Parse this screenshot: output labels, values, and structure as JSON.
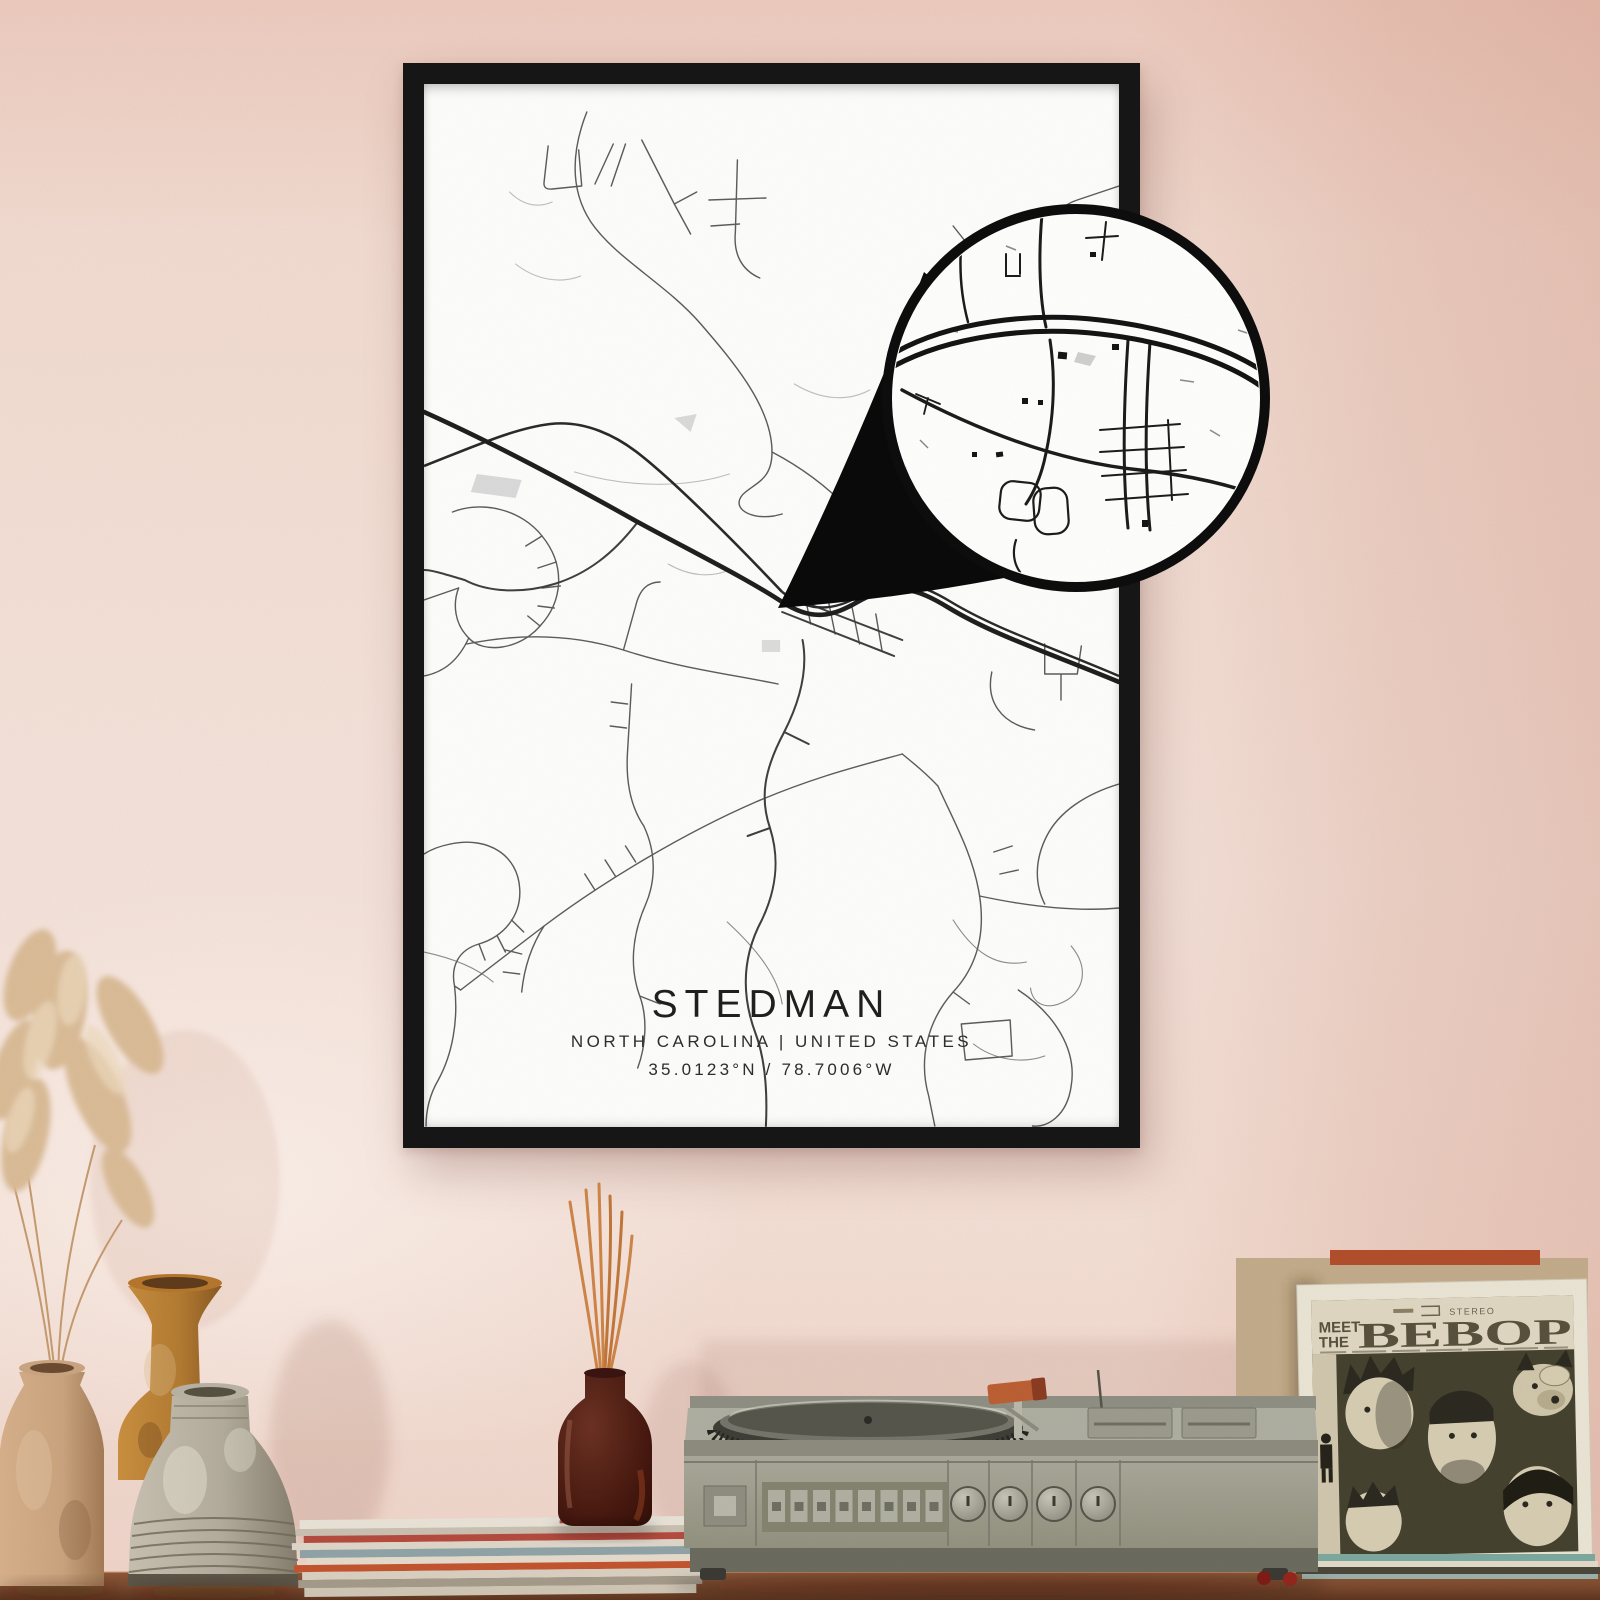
{
  "poster": {
    "title": "STEDMAN",
    "subtitle": "NORTH CAROLINA | UNITED STATES",
    "coordinates": "35.0123°N / 78.7006°W"
  },
  "record_sleeve": {
    "pretitle_line1": "MEET",
    "pretitle_line2": "THE",
    "title": "BEBOP",
    "stereo_label": "STEREO"
  },
  "colors": {
    "wall_pink": "#f1dcd2",
    "wall_shadow": "#dfae9c",
    "frame": "#161616",
    "paper": "#fcfcfa",
    "road_major": "#1f1f1f",
    "road_minor": "#5c5c5c",
    "wood_shelf": "#7c4a2f",
    "turntable_body": "#a3a294",
    "diffuser_glass": "#46180f",
    "reed_sticks": "#cd8448",
    "vase_tan": "#c9a37e",
    "vase_amber": "#b27a31",
    "vase_gray": "#b3ac9c",
    "sleeve_art": "#45412f",
    "sleeve_paper": "#e9e3d3",
    "pampas": "#d9bb96"
  }
}
